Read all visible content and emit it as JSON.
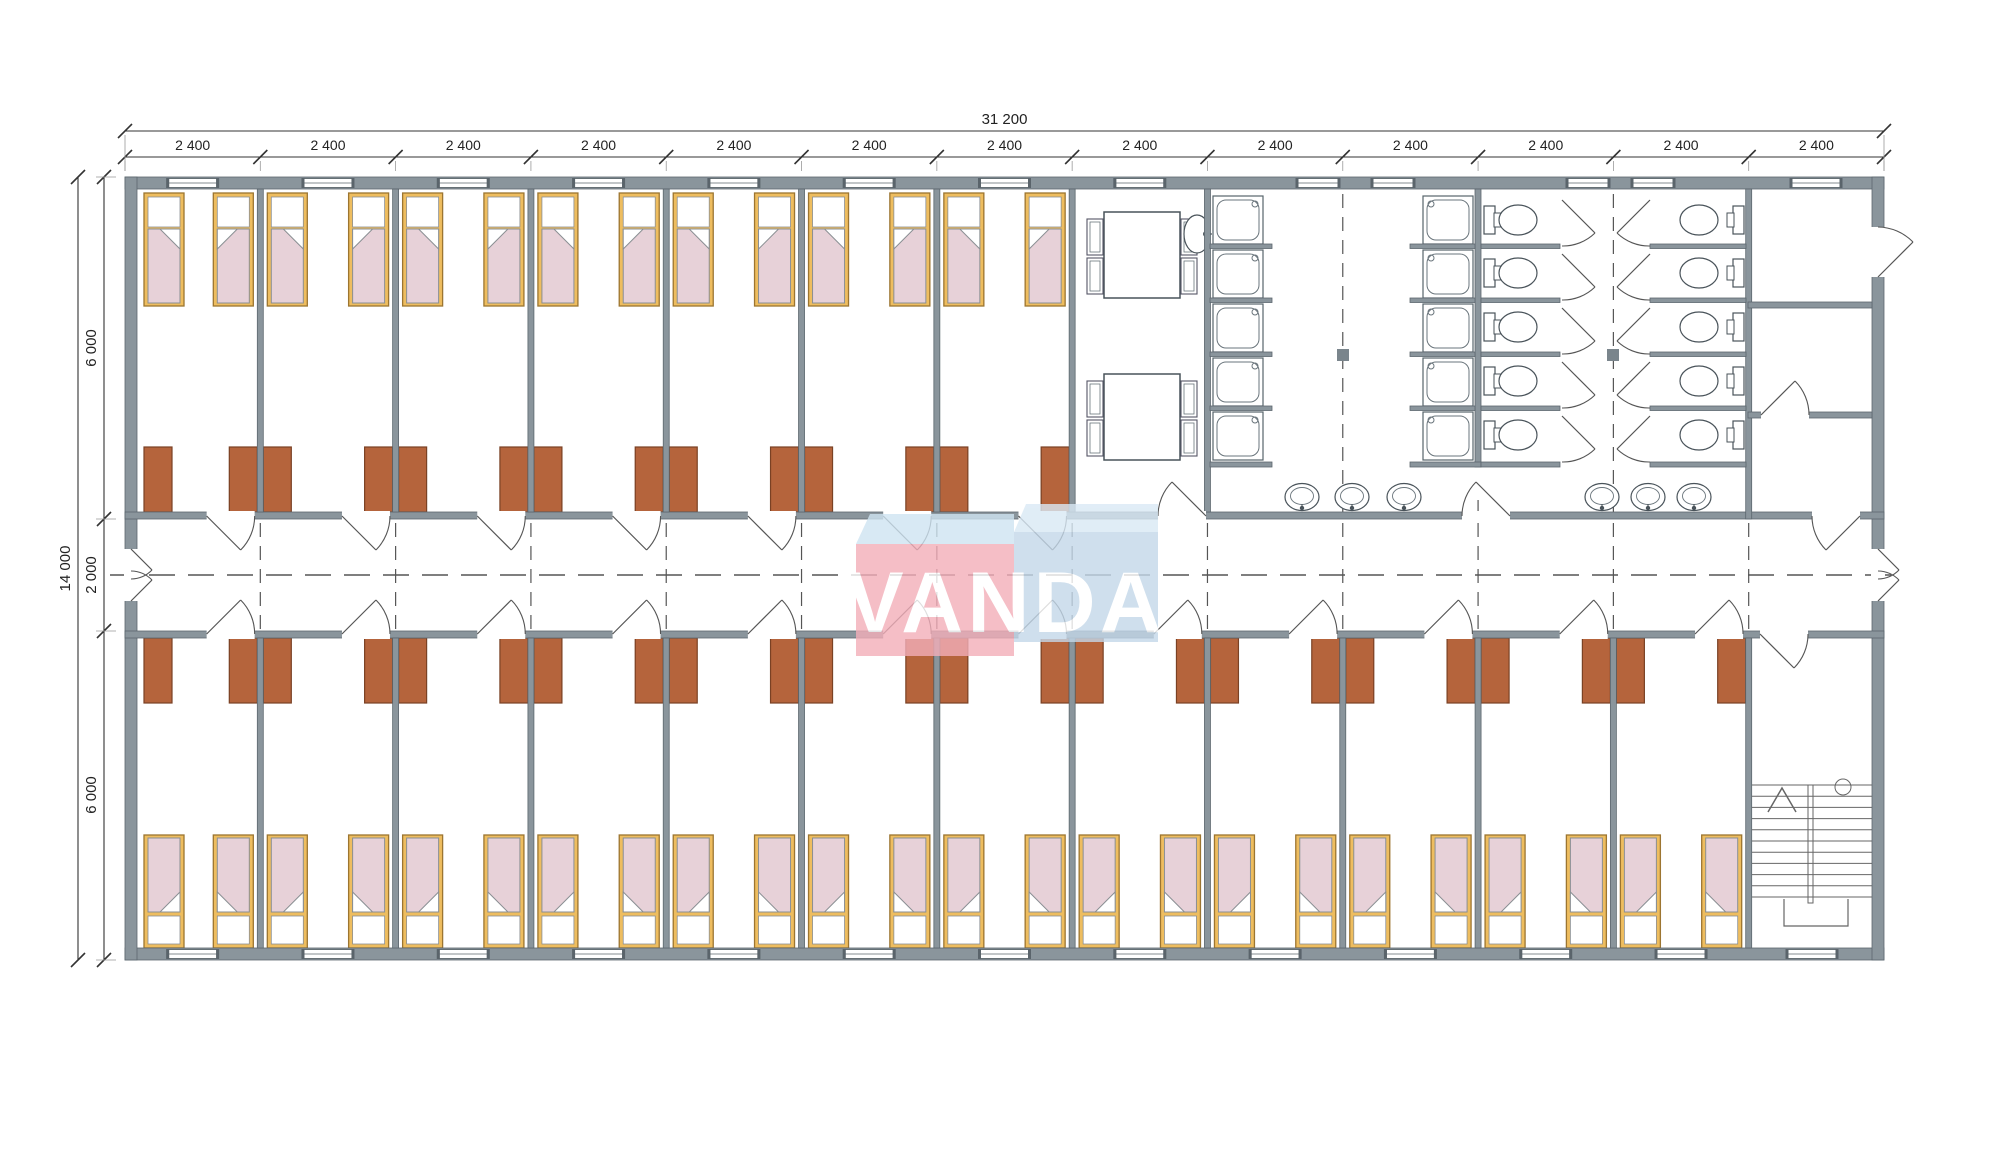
{
  "drawing": {
    "kind": "floor-plan",
    "module_count": 13
  },
  "dimensions": {
    "total_width_label": "31 200",
    "module_width_label": "2 400",
    "total_height_label": "14 000",
    "height_segment_labels": [
      "6 000",
      "2 000",
      "6 000"
    ]
  },
  "watermark": {
    "text": "VANDA",
    "red_block": "#f3aeb9",
    "red_top_band": "#cfe4f2",
    "blue_block": "#c4d8e9",
    "blue_top_band": "#d9e9f5",
    "text_color": "#ffffff"
  },
  "colors": {
    "floor": "#ffffff",
    "wall_fill": "#8a959c",
    "wall_edge": "#5c676e",
    "bed_frame": "#eebd5f",
    "bed_frame_edge": "#9c7531",
    "mattress": "#e7d1d8",
    "mattress_edge": "#8a8f93",
    "wardrobe": "#b5643c",
    "wardrobe_edge": "#7a4124",
    "fixture_line": "#49535a",
    "fixture_line_light": "#6a757c",
    "axis_dash": "#555555",
    "dim_line": "#333333",
    "dim_text": "#222222",
    "column_fill": "#7a858c"
  },
  "fixtures": {
    "beds_top_row": 14,
    "beds_bottom_row": 24,
    "wardrobes": 38,
    "dining_tables": 2,
    "chairs": 8,
    "showers": 10,
    "toilets": 10,
    "corridor_washbasins": 6,
    "canteen_washbasin": 1,
    "staircases": 1
  }
}
